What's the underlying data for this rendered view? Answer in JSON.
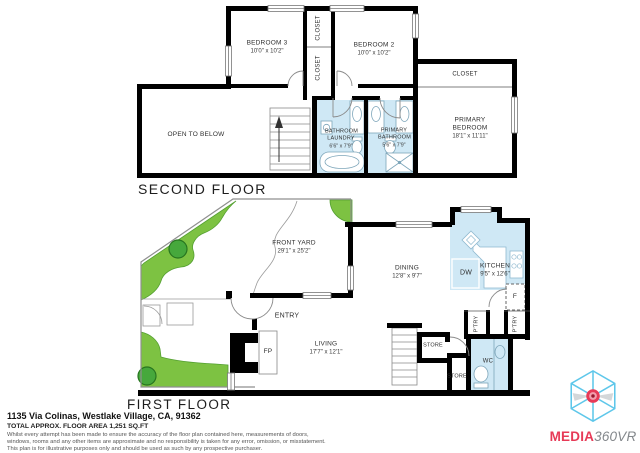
{
  "second_floor": {
    "floor_label": "SECOND FLOOR",
    "rooms": {
      "bedroom3": {
        "name": "BEDROOM 3",
        "dims": "10'0\" x 10'2\""
      },
      "bedroom2": {
        "name": "BEDROOM 2",
        "dims": "10'0\" x 10'2\""
      },
      "closet_upper": {
        "name": "CLOSET"
      },
      "closet_lower": {
        "name": "CLOSET"
      },
      "closet_primary": {
        "name": "CLOSET"
      },
      "primary_bedroom": {
        "name": "PRIMARY BEDROOM",
        "dims": "18'1\" x 11'11\""
      },
      "bathroom_laundry": {
        "name": "BATHROOM LAUNDRY",
        "dims": "6'6\" x 7'9\""
      },
      "primary_bathroom": {
        "name": "PRIMARY BATHROOM",
        "dims": "5'6\" x 7'9\""
      },
      "open_to_below": {
        "name": "OPEN TO BELOW"
      }
    }
  },
  "first_floor": {
    "floor_label": "FIRST FLOOR",
    "rooms": {
      "front_yard": {
        "name": "FRONT YARD",
        "dims": "29'1\" x 25'2\""
      },
      "dining": {
        "name": "DINING",
        "dims": "12'8\" x 9'7\""
      },
      "kitchen": {
        "name": "KITCHEN",
        "dims": "9'5\" x 12'6\""
      },
      "living": {
        "name": "LIVING",
        "dims": "17'7\" x 12'1\""
      },
      "entry": {
        "name": "ENTRY"
      },
      "fireplace": {
        "name": "FP"
      },
      "dishwasher": {
        "name": "DW"
      },
      "fridge": {
        "name": "F"
      },
      "store_upper": {
        "name": "STORE"
      },
      "store_lower": {
        "name": "STORE"
      },
      "wc": {
        "name": "WC"
      },
      "pantry_left": {
        "name": "P'TRY"
      },
      "pantry_right": {
        "name": "P'TRY"
      }
    }
  },
  "footer": {
    "address": "1135 Via Colinas, Westlake Village, CA, 91362",
    "area": "TOTAL APPROX. FLOOR AREA 1,251 SQ.FT",
    "disclaimer1": "Whilst every attempt has been made to ensure the accuracy of the floor plan contained here, measurements of doors,",
    "disclaimer2": "windows, rooms and any other items are approximate and no responsibility is taken for any error, omission, or misstatement.",
    "disclaimer3": "This plan is for illustrative purposes only and should be used as such by any prospective purchaser."
  },
  "logo": {
    "brand_primary": "MEDIA",
    "brand_secondary": "360VR"
  },
  "colors": {
    "wall": "#000000",
    "wet_room_fill": "#cfe8f5",
    "landscape_green": "#7dc242",
    "tree_green": "#46a83c",
    "logo_red": "#e73a57",
    "logo_blue": "#5ec7ea",
    "logo_gray": "#83878b"
  }
}
